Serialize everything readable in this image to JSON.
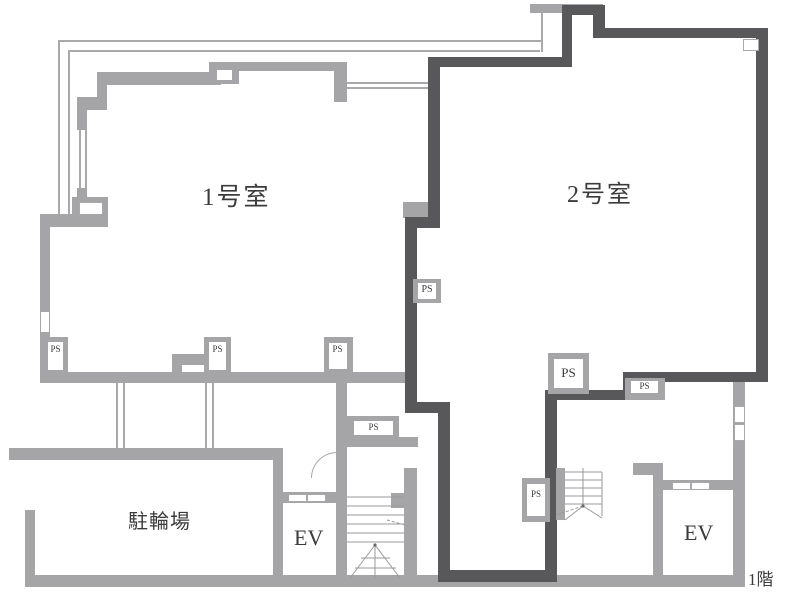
{
  "title": "1階 間取り図 (first floor plan)",
  "colors": {
    "wall_light": "#a5a5a7",
    "wall_dark": "#58585a",
    "thin_line": "#a9a9ab",
    "text": "#3b3b3b"
  },
  "plan": {
    "rooms": [
      {
        "id": "room1",
        "label": "1号室"
      },
      {
        "id": "room2",
        "label": "2号室"
      },
      {
        "id": "bicycle-parking",
        "label": "駐輪場"
      }
    ],
    "elevator_label": "EV",
    "pipe_space_label": "PS",
    "floor_label": "1階"
  }
}
